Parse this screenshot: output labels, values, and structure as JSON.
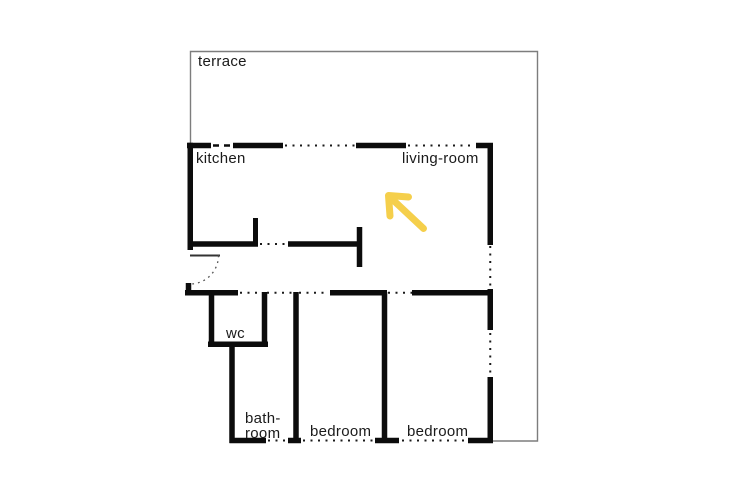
{
  "colors": {
    "wall": "#0c0c0c",
    "terrace_outline": "#7d7d7d",
    "arrow": "#f5cf4b",
    "text": "#1a1a1a",
    "background": "#ffffff"
  },
  "rooms": {
    "terrace": {
      "label": "terrace"
    },
    "kitchen": {
      "label": "kitchen"
    },
    "living_room": {
      "label": "living-room"
    },
    "wc": {
      "label": "wc"
    },
    "bathroom": {
      "label_line1": "bath-",
      "label_line2": "room"
    },
    "bedroom_1": {
      "label": "bedroom"
    },
    "bedroom_2": {
      "label": "bedroom"
    }
  },
  "annotation": {
    "arrow": {
      "direction": "up-left",
      "color": "#f5cf4b"
    }
  }
}
